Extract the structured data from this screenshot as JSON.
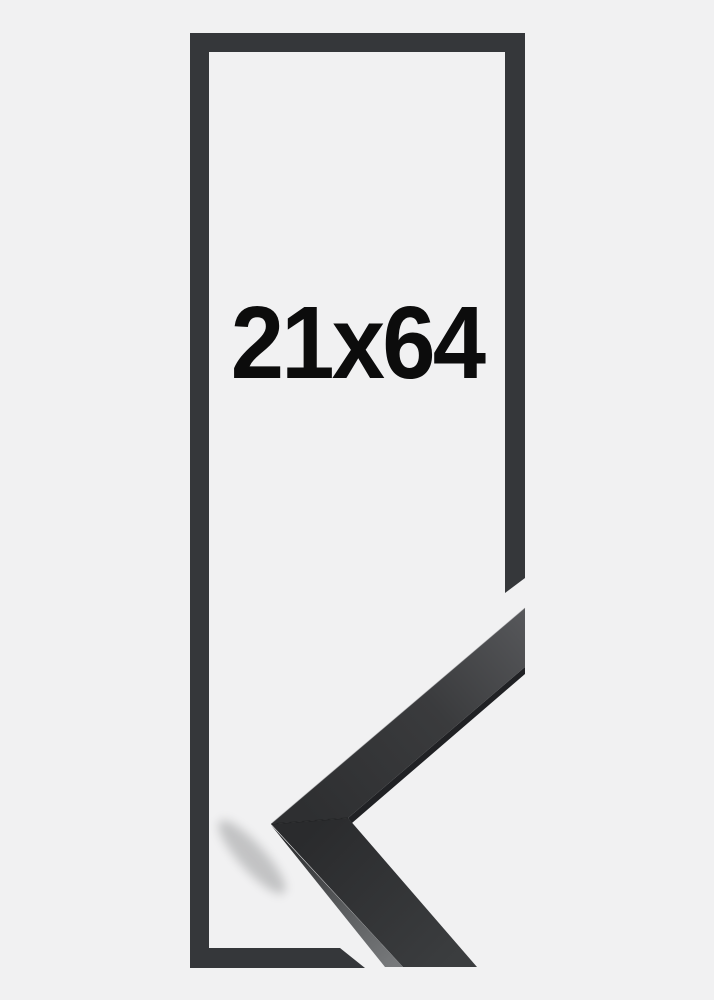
{
  "product": {
    "size_label": "21x64",
    "frame_color_name": "black",
    "view": "empty-frame-outline-with-corner-profile-sample"
  },
  "colors": {
    "background": "#f1f1f2",
    "frame_dark": "#35373a",
    "label_text": "#0c0c0c",
    "corner_face_light": "#57585b",
    "corner_face_dark": "#2e2f31",
    "corner_side_gray": "#77797b",
    "corner_underside": "#202124"
  }
}
